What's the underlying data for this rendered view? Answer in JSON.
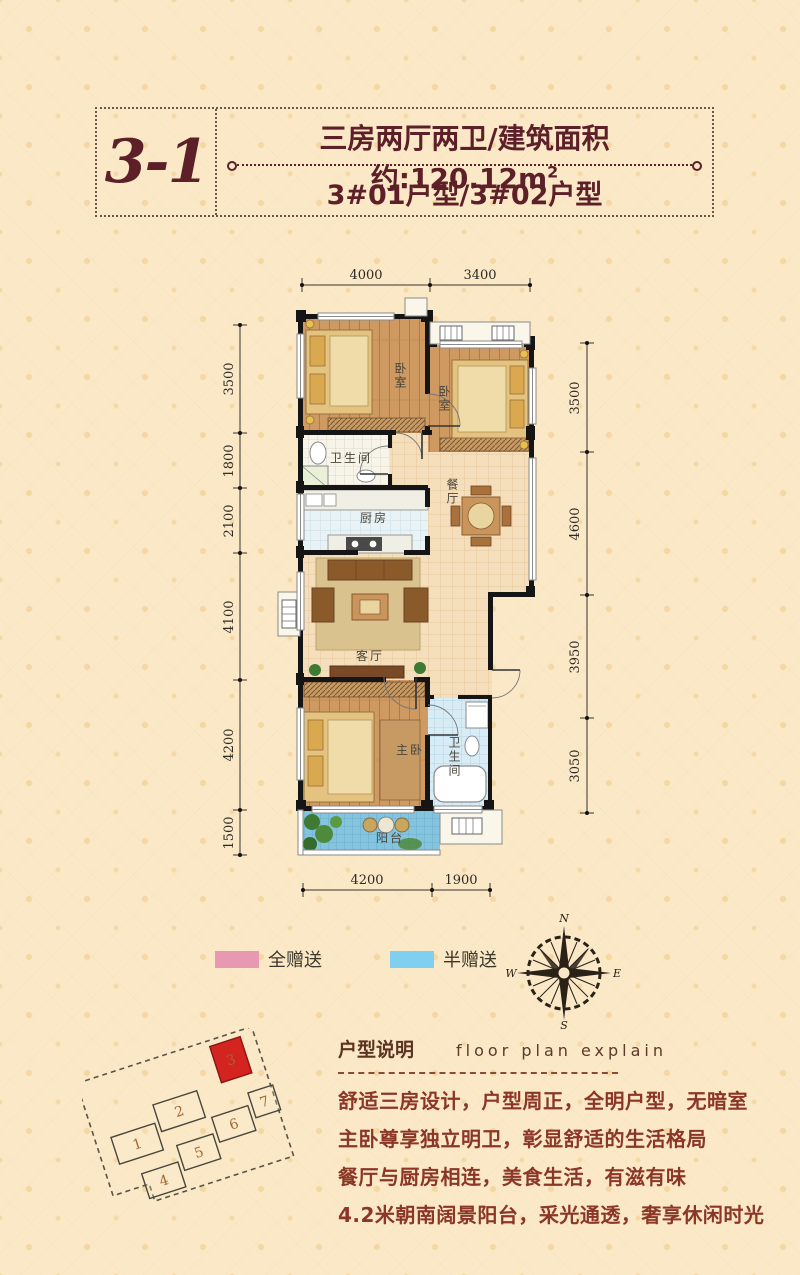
{
  "colors": {
    "background": "#FAE8C7",
    "maroon_title": "#5D1F28",
    "body_text": "#8B3626",
    "wall": "#151515",
    "wood_floor": "#CE9A62",
    "tile_floor": "#F5DEBC",
    "kitchen_tile": "#E9F2F5",
    "bath_tile": "#D8ECF5",
    "balcony_tile": "#85C4DE",
    "legend_full": "#E898B0",
    "legend_half": "#7FD0F0",
    "site_highlight": "#D3241F"
  },
  "header": {
    "unit_code": "3-1",
    "title": "三房两厅两卫/建筑面积约:120.12m",
    "title_sup": "2",
    "subtitle": "3#01户型/3#02户型"
  },
  "plan": {
    "rooms": [
      {
        "id": "bedroom-1",
        "label": "卧室"
      },
      {
        "id": "bedroom-2",
        "label": "卧室"
      },
      {
        "id": "bathroom-1",
        "label": "卫生间"
      },
      {
        "id": "kitchen",
        "label": "厨房"
      },
      {
        "id": "dining-room",
        "label": "餐厅"
      },
      {
        "id": "living-room",
        "label": "客厅"
      },
      {
        "id": "master-bedroom",
        "label": "主卧"
      },
      {
        "id": "bathroom-2",
        "label": "卫生间"
      },
      {
        "id": "balcony",
        "label": "阳台"
      }
    ],
    "dimensions": {
      "top": [
        "4000",
        "3400"
      ],
      "bottom": [
        "4200",
        "1900"
      ],
      "left": [
        "3500",
        "1800",
        "2100",
        "4100",
        "4200",
        "1500"
      ],
      "right": [
        "3500",
        "4600",
        "3950",
        "3050"
      ]
    }
  },
  "legend": {
    "items": [
      {
        "label": "全赠送",
        "color": "#E898B0"
      },
      {
        "label": "半赠送",
        "color": "#7FD0F0"
      }
    ]
  },
  "compass": {
    "north": "N",
    "east": "E",
    "south": "S",
    "west": "W"
  },
  "site_plan": {
    "buildings": [
      "1",
      "2",
      "3",
      "4",
      "5",
      "6",
      "7"
    ],
    "highlighted": "3"
  },
  "explain": {
    "title_cn": "户型说明",
    "title_en": "floor plan explain",
    "lines": [
      "舒适三房设计，户型周正，全明户型，无暗室",
      "主卧尊享独立明卫，彰显舒适的生活格局",
      "餐厅与厨房相连，美食生活，有滋有味",
      "4.2米朝南阔景阳台，采光通透，奢享休闲时光"
    ]
  }
}
